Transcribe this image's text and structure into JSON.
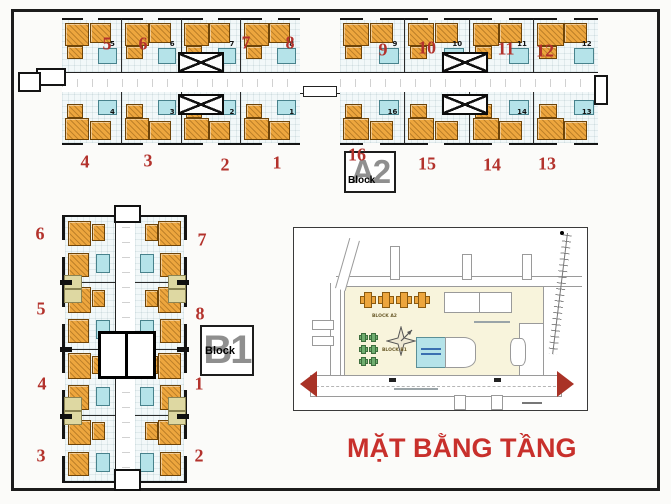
{
  "page": {
    "background": "#fbfbf9",
    "frame_color": "#1c1c1c"
  },
  "colors": {
    "annotation_red": "#b3322c",
    "title_red": "#c8302c",
    "unit_orange": "#eda63e",
    "bath_cyan": "#b5e3e9",
    "site_green": "#6fae6f",
    "site_yellow": "#f8f4dc",
    "arrow_red": "#a93226",
    "label_gray": "#8f8f8f"
  },
  "title": {
    "text": "MẶT BẰNG TẦNG"
  },
  "block_a2": {
    "label_big": "A2",
    "label_small": "Block",
    "top_unit_numbers": [
      "5",
      "6",
      "7",
      "8",
      "9",
      "10",
      "11",
      "12"
    ],
    "bottom_unit_numbers": [
      "4",
      "3",
      "2",
      "1",
      "16",
      "15",
      "14",
      "13"
    ],
    "red_annotations": [
      {
        "text": "5",
        "x": 107,
        "y": 44
      },
      {
        "text": "6",
        "x": 143,
        "y": 44
      },
      {
        "text": "7",
        "x": 246,
        "y": 43
      },
      {
        "text": "8",
        "x": 290,
        "y": 43
      },
      {
        "text": "9",
        "x": 383,
        "y": 50
      },
      {
        "text": "10",
        "x": 427,
        "y": 48
      },
      {
        "text": "11",
        "x": 506,
        "y": 49
      },
      {
        "text": "12",
        "x": 545,
        "y": 51
      },
      {
        "text": "4",
        "x": 85,
        "y": 162
      },
      {
        "text": "3",
        "x": 148,
        "y": 161
      },
      {
        "text": "2",
        "x": 225,
        "y": 165
      },
      {
        "text": "1",
        "x": 277,
        "y": 163
      },
      {
        "text": "16",
        "x": 357,
        "y": 155
      },
      {
        "text": "15",
        "x": 427,
        "y": 164
      },
      {
        "text": "14",
        "x": 492,
        "y": 165
      },
      {
        "text": "13",
        "x": 547,
        "y": 164
      }
    ]
  },
  "block_b1": {
    "label_big": "B1",
    "label_small": "Block",
    "red_annotations": [
      {
        "text": "6",
        "x": 40,
        "y": 234
      },
      {
        "text": "7",
        "x": 202,
        "y": 240
      },
      {
        "text": "5",
        "x": 41,
        "y": 309
      },
      {
        "text": "8",
        "x": 200,
        "y": 314
      },
      {
        "text": "4",
        "x": 42,
        "y": 384
      },
      {
        "text": "1",
        "x": 199,
        "y": 384
      },
      {
        "text": "3",
        "x": 41,
        "y": 456
      },
      {
        "text": "2",
        "x": 199,
        "y": 456
      }
    ]
  },
  "site_map": {
    "labels": {
      "block_a2": "BLOCK A2",
      "block_b1": "BLOCK B1"
    }
  }
}
